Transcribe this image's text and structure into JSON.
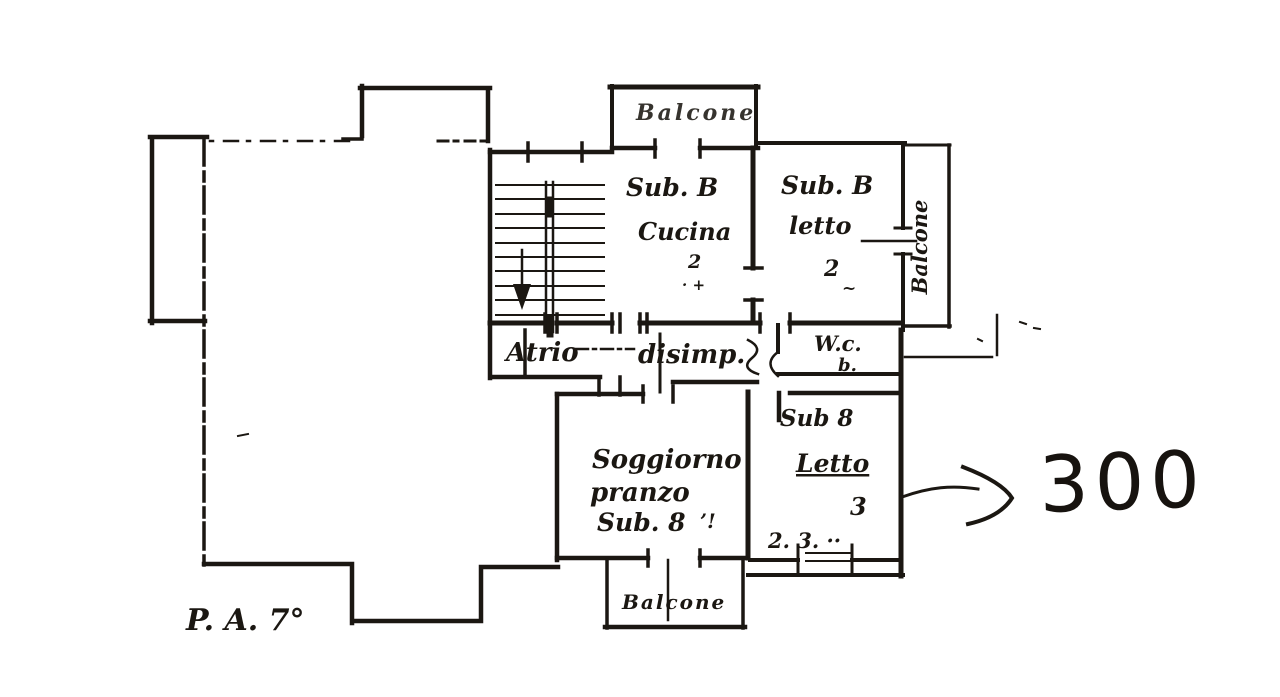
{
  "drawing": {
    "floor_label": "P. A. 7°",
    "price_annotation": "300",
    "balconies": {
      "top": "Balcone",
      "right": "Balcone",
      "bottom": "Balcone"
    },
    "rooms": {
      "kitchen": {
        "sub": "Sub. B",
        "name": "Cucina",
        "number": "2",
        "marks": "· +"
      },
      "bedroom1": {
        "sub": "Sub. B",
        "name": "letto",
        "number": "2",
        "marks": "~"
      },
      "hall": {
        "name": "Atrio"
      },
      "corridor": {
        "name": "disimp."
      },
      "wc": {
        "name": "W.c.",
        "sub": "b."
      },
      "living": {
        "line1": "Soggiorno",
        "line2": "pranzo",
        "line3": "Sub. 8",
        "marks": "’!"
      },
      "bedroom2": {
        "sub": "Sub 8",
        "name": "Letto",
        "number": "3",
        "dimension": "2. 3. ··"
      }
    }
  }
}
